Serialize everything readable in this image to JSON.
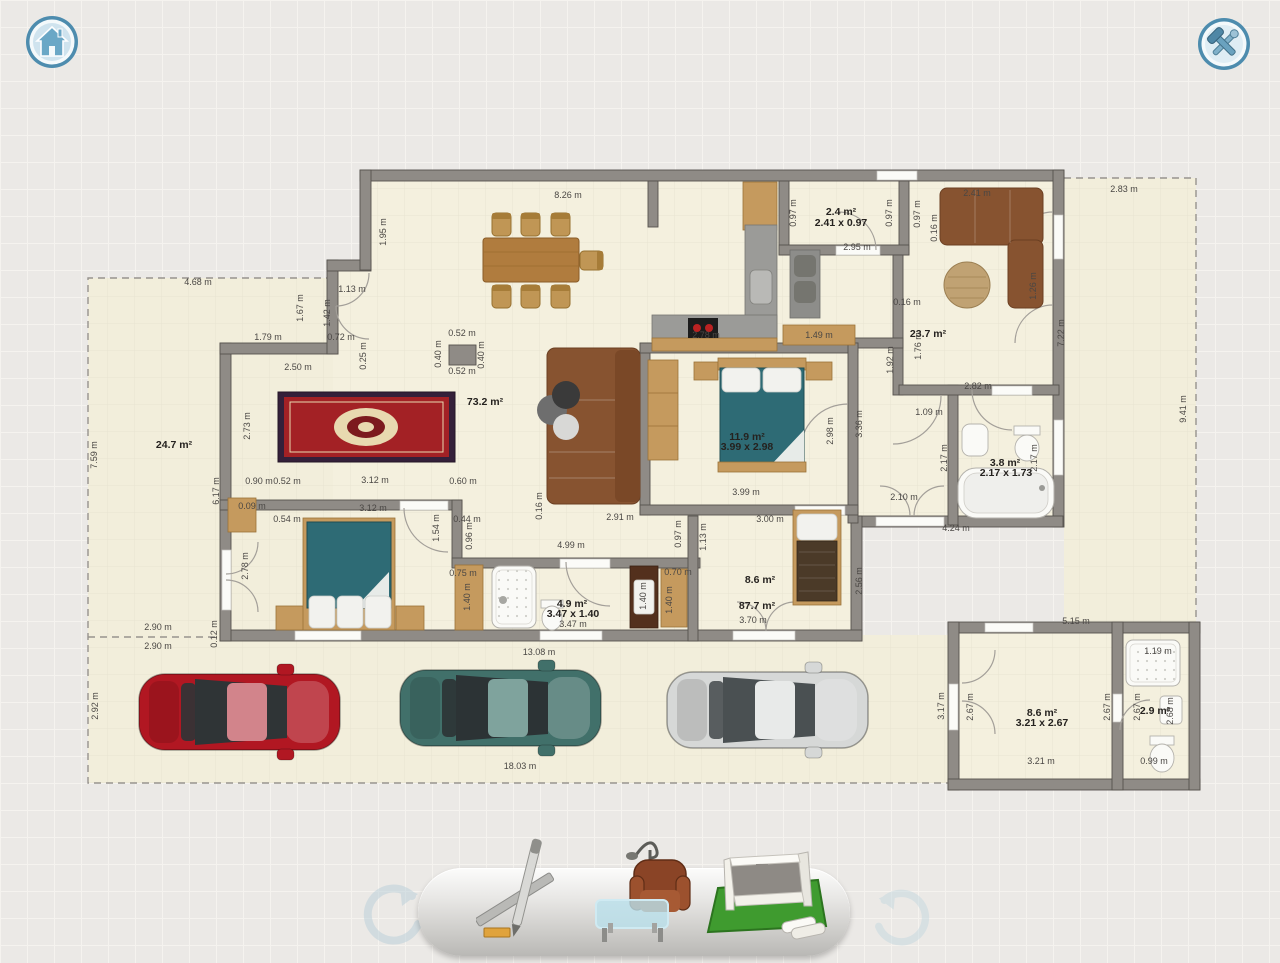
{
  "header": {
    "home_button_icon": "home-icon",
    "tools_button_icon": "tools-hammer-screwdriver-icon"
  },
  "tray": {
    "tools": [
      {
        "id": "draw-tool",
        "icon": "pencil-ruler-icon"
      },
      {
        "id": "furniture-tool",
        "icon": "armchair-table-lamp-icon"
      },
      {
        "id": "rooms-tool",
        "icon": "house-model-on-grass-icon"
      }
    ],
    "undo_icon": "undo-arrow-icon",
    "redo_icon": "redo-arrow-icon"
  },
  "colors": {
    "accent_blue": "#4d8cae",
    "wall_gray": "#8f8b86",
    "floor_cream": "#f4f0de",
    "bed_teal": "#2e6b75",
    "sofa_brown": "#875330",
    "rug_red": "#a32125",
    "car_red": "#b11722",
    "car_teal": "#41706a",
    "car_silver": "#d6d8d7"
  },
  "plan": {
    "unit": "m",
    "labels": [
      {
        "t": "8.26 m",
        "x": 568,
        "y": 198
      },
      {
        "t": "1.95 m",
        "x": 386,
        "y": 232,
        "r": -90
      },
      {
        "t": "0.97 m",
        "x": 796,
        "y": 213,
        "r": -90
      },
      {
        "t": "2.4 m²",
        "x": 841,
        "y": 215,
        "b": 1
      },
      {
        "t": "2.41 x 0.97",
        "x": 841,
        "y": 226,
        "b": 1
      },
      {
        "t": "0.97 m",
        "x": 892,
        "y": 213,
        "r": -90
      },
      {
        "t": "0.97 m",
        "x": 920,
        "y": 214,
        "r": -90
      },
      {
        "t": "0.16 m",
        "x": 937,
        "y": 228,
        "r": -90
      },
      {
        "t": "2.41 m",
        "x": 977,
        "y": 196
      },
      {
        "t": "2.83 m",
        "x": 1124,
        "y": 192
      },
      {
        "t": "2.95 m",
        "x": 857,
        "y": 250
      },
      {
        "t": "0.16 m",
        "x": 907,
        "y": 305
      },
      {
        "t": "23.7 m²",
        "x": 928,
        "y": 337,
        "b": 1
      },
      {
        "t": "1.92 m",
        "x": 893,
        "y": 360,
        "r": -90
      },
      {
        "t": "1.76 m",
        "x": 921,
        "y": 346,
        "r": -90
      },
      {
        "t": "1.26 m",
        "x": 1036,
        "y": 286,
        "r": -90
      },
      {
        "t": "7.22 m",
        "x": 1064,
        "y": 333,
        "r": -90
      },
      {
        "t": "9.41 m",
        "x": 1186,
        "y": 409,
        "r": -90
      },
      {
        "t": "4.68 m",
        "x": 198,
        "y": 285
      },
      {
        "t": "7.59 m",
        "x": 97,
        "y": 455,
        "r": -90
      },
      {
        "t": "24.7 m²",
        "x": 174,
        "y": 448,
        "b": 1
      },
      {
        "t": "1.67 m",
        "x": 303,
        "y": 308,
        "r": -90
      },
      {
        "t": "1.13 m",
        "x": 352,
        "y": 292
      },
      {
        "t": "1.42 m",
        "x": 330,
        "y": 313,
        "r": -90
      },
      {
        "t": "0.72 m",
        "x": 341,
        "y": 340
      },
      {
        "t": "1.79 m",
        "x": 268,
        "y": 340
      },
      {
        "t": "0.25 m",
        "x": 366,
        "y": 356,
        "r": -90
      },
      {
        "t": "2.50 m",
        "x": 298,
        "y": 370
      },
      {
        "t": "2.73 m",
        "x": 250,
        "y": 426,
        "r": -90
      },
      {
        "t": "0.52 m",
        "x": 462,
        "y": 336
      },
      {
        "t": "0.40 m",
        "x": 441,
        "y": 354,
        "r": -90
      },
      {
        "t": "0.40 m",
        "x": 484,
        "y": 355,
        "r": -90
      },
      {
        "t": "0.52 m",
        "x": 462,
        "y": 374
      },
      {
        "t": "73.2 m²",
        "x": 485,
        "y": 405,
        "b": 1
      },
      {
        "t": "2.78 m",
        "x": 706,
        "y": 338
      },
      {
        "t": "1.49 m",
        "x": 819,
        "y": 338
      },
      {
        "t": "11.9 m²",
        "x": 747,
        "y": 440,
        "b": 1
      },
      {
        "t": "3.99 x 2.98",
        "x": 747,
        "y": 450,
        "b": 1
      },
      {
        "t": "3.99 m",
        "x": 746,
        "y": 495
      },
      {
        "t": "2.98 m",
        "x": 833,
        "y": 431,
        "r": -90
      },
      {
        "t": "3.36 m",
        "x": 862,
        "y": 424,
        "r": -90
      },
      {
        "t": "2.82 m",
        "x": 978,
        "y": 389
      },
      {
        "t": "1.09 m",
        "x": 929,
        "y": 415
      },
      {
        "t": "2.17 m",
        "x": 947,
        "y": 458,
        "r": -90
      },
      {
        "t": "3.8 m²",
        "x": 1005,
        "y": 466,
        "b": 1
      },
      {
        "t": "2.17 x 1.73",
        "x": 1006,
        "y": 476,
        "b": 1
      },
      {
        "t": "2.17 m",
        "x": 1037,
        "y": 458,
        "r": -90
      },
      {
        "t": "2.10 m",
        "x": 904,
        "y": 500
      },
      {
        "t": "4.24 m",
        "x": 956,
        "y": 531
      },
      {
        "t": "6.17 m",
        "x": 219,
        "y": 491,
        "r": -90
      },
      {
        "t": "0.90 m",
        "x": 259,
        "y": 484
      },
      {
        "t": "0.52 m",
        "x": 287,
        "y": 484
      },
      {
        "t": "3.12 m",
        "x": 375,
        "y": 483
      },
      {
        "t": "0.60 m",
        "x": 463,
        "y": 484
      },
      {
        "t": "0.09 m",
        "x": 252,
        "y": 509
      },
      {
        "t": "0.54 m",
        "x": 287,
        "y": 522
      },
      {
        "t": "3.12 m",
        "x": 373,
        "y": 511
      },
      {
        "t": "1.54 m",
        "x": 439,
        "y": 528,
        "r": -90
      },
      {
        "t": "0.44 m",
        "x": 467,
        "y": 522
      },
      {
        "t": "0.96 m",
        "x": 472,
        "y": 536,
        "r": -90
      },
      {
        "t": "2.78 m",
        "x": 248,
        "y": 566,
        "r": -90
      },
      {
        "t": "0.75 m",
        "x": 463,
        "y": 576
      },
      {
        "t": "1.40 m",
        "x": 470,
        "y": 597,
        "r": -90
      },
      {
        "t": "4.99 m",
        "x": 571,
        "y": 548
      },
      {
        "t": "2.91 m",
        "x": 620,
        "y": 520
      },
      {
        "t": "0.16 m",
        "x": 542,
        "y": 506,
        "r": -90
      },
      {
        "t": "0.97 m",
        "x": 681,
        "y": 534,
        "r": -90
      },
      {
        "t": "1.13 m",
        "x": 706,
        "y": 537,
        "r": -90
      },
      {
        "t": "4.9 m²",
        "x": 572,
        "y": 607,
        "b": 1
      },
      {
        "t": "3.47 x 1.40",
        "x": 573,
        "y": 617,
        "b": 1
      },
      {
        "t": "3.47 m",
        "x": 573,
        "y": 627
      },
      {
        "t": "1.40 m",
        "x": 646,
        "y": 596,
        "r": -90
      },
      {
        "t": "0.70 m",
        "x": 678,
        "y": 575
      },
      {
        "t": "1.40 m",
        "x": 672,
        "y": 600,
        "r": -90
      },
      {
        "t": "13.08 m",
        "x": 539,
        "y": 655
      },
      {
        "t": "3.00 m",
        "x": 770,
        "y": 522
      },
      {
        "t": "8.6 m²",
        "x": 760,
        "y": 583,
        "b": 1
      },
      {
        "t": "87.7 m²",
        "x": 757,
        "y": 609,
        "b": 1
      },
      {
        "t": "3.70 m",
        "x": 753,
        "y": 623
      },
      {
        "t": "2.56 m",
        "x": 862,
        "y": 581,
        "r": -90
      },
      {
        "t": "5.15 m",
        "x": 1076,
        "y": 624
      },
      {
        "t": "3.17 m",
        "x": 944,
        "y": 706,
        "r": -90
      },
      {
        "t": "2.67 m",
        "x": 973,
        "y": 707,
        "r": -90
      },
      {
        "t": "8.6 m²",
        "x": 1042,
        "y": 716,
        "b": 1
      },
      {
        "t": "3.21 x 2.67",
        "x": 1042,
        "y": 726,
        "b": 1
      },
      {
        "t": "2.67 m",
        "x": 1110,
        "y": 707,
        "r": -90
      },
      {
        "t": "2.67 m",
        "x": 1140,
        "y": 707,
        "r": -90
      },
      {
        "t": "2.9 m²",
        "x": 1155,
        "y": 714,
        "b": 1
      },
      {
        "t": "2.68 m",
        "x": 1173,
        "y": 711,
        "r": -90
      },
      {
        "t": "1.19 m",
        "x": 1158,
        "y": 654
      },
      {
        "t": "0.99 m",
        "x": 1154,
        "y": 764
      },
      {
        "t": "3.21 m",
        "x": 1041,
        "y": 764
      },
      {
        "t": "2.90 m",
        "x": 158,
        "y": 630
      },
      {
        "t": "2.90 m",
        "x": 158,
        "y": 649
      },
      {
        "t": "2.92 m",
        "x": 98,
        "y": 706,
        "r": -90
      },
      {
        "t": "0.12 m",
        "x": 217,
        "y": 634,
        "r": -90
      },
      {
        "t": "18.03 m",
        "x": 520,
        "y": 769
      }
    ]
  }
}
